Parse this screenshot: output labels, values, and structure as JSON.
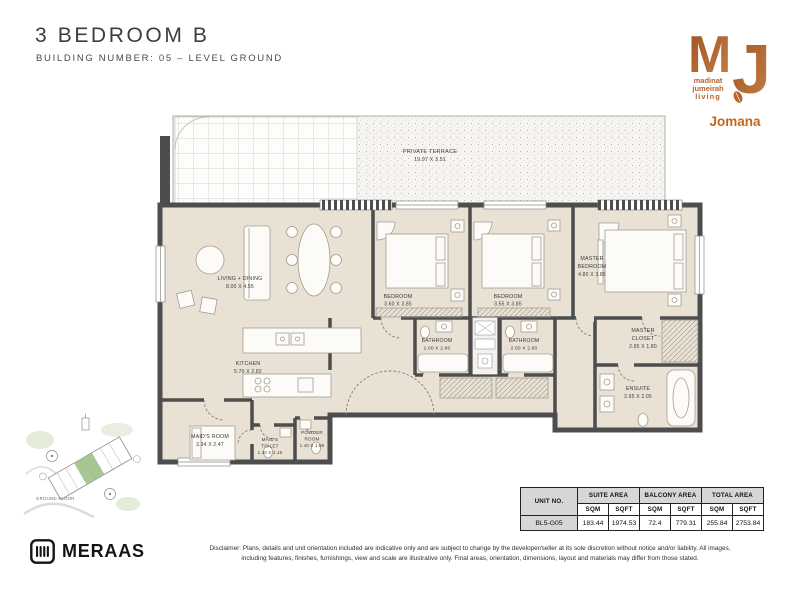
{
  "page": {
    "title": "3 BEDROOM B",
    "subtitle": "BUILDING NUMBER: 05 – LEVEL GROUND"
  },
  "brand": {
    "mj": {
      "m": "M",
      "j": "J",
      "tagline1": "madinat",
      "tagline2": "jumeirah",
      "tagline3": "living",
      "project": "Jomana",
      "accent_color": "#b5632d",
      "project_color": "#c2671d"
    },
    "meraas": {
      "name": "MERAAS",
      "color": "#141414"
    }
  },
  "keyplan": {
    "label": "GROUND FLOOR"
  },
  "floorplan": {
    "wall_color": "#4d4d4d",
    "floor_color": "#e9e1d4",
    "rooms": {
      "terrace": {
        "name": "PRIVATE TERRACE",
        "dims": "19.97 X 3.51"
      },
      "living": {
        "name": "LIVING + DINING",
        "dims": "8.00 X 4.55"
      },
      "kitchen": {
        "name": "KITCHEN",
        "dims": "5.70 X 2.82"
      },
      "maids": {
        "name": "MAID'S ROOM",
        "dims": "3.34 X 2.47"
      },
      "maids_toilet": {
        "name1": "MAID'S",
        "name2": "TOILET",
        "dims": "1.40 X 2.16"
      },
      "powder": {
        "name1": "POWDER",
        "name2": "ROOM",
        "dims": "1.40 X 1.88"
      },
      "bedroom1": {
        "name": "BEDROOM",
        "dims": "3.60 X 3.85"
      },
      "bedroom2": {
        "name": "BEDROOM",
        "dims": "3.55 X 3.85"
      },
      "bathroom1": {
        "name": "BATHROOM",
        "dims": "2.00 X 2.60"
      },
      "bathroom2": {
        "name": "BATHROOM",
        "dims": "2.00 X 2.60"
      },
      "master": {
        "name1": "MASTER",
        "name2": "BEDROOM",
        "dims": "4.80 X 3.85"
      },
      "closet": {
        "name1": "MASTER",
        "name2": "CLOSET",
        "dims": "2.95 X 1.80"
      },
      "ensuite": {
        "name": "ENSUITE",
        "dims": "2.95 X 2.05"
      }
    }
  },
  "area_table": {
    "unit_header": "UNIT NO.",
    "sqm_label": "SQM",
    "sqft_label": "SQFT",
    "unit_no": "BL5-G05",
    "groups": [
      {
        "label": "SUITE AREA",
        "sqm": "183.44",
        "sqft": "1974.53"
      },
      {
        "label": "BALCONY AREA",
        "sqm": "72.4",
        "sqft": "779.31"
      },
      {
        "label": "TOTAL AREA",
        "sqm": "255.84",
        "sqft": "2753.84"
      }
    ]
  },
  "disclaimer": {
    "line1": "Disclaimer: Plans, details and unit orientation included are indicative only and are subject to change by the developer/seller at its sole discretion without notice and/or liability. All images,",
    "line2": "including features, finishes, furnishings, view and scale are illustrative only. Final areas, orientation, dimensions, layout and materials may differ from those stated."
  }
}
